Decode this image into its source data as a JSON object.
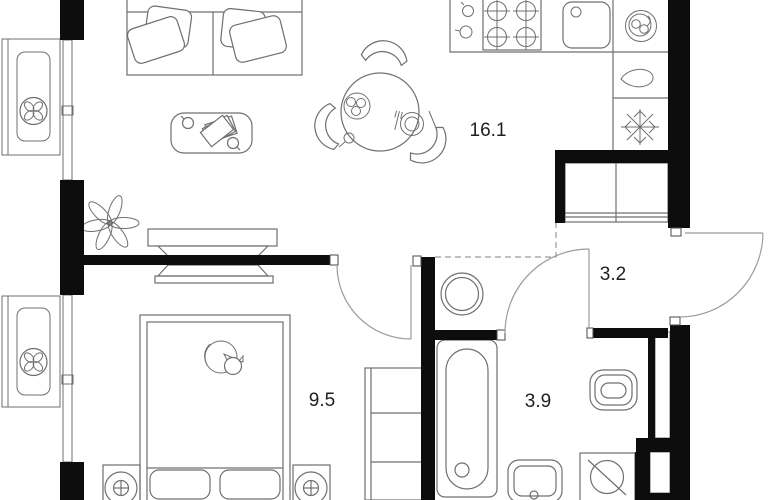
{
  "floor_plan": {
    "rooms": [
      {
        "id": "kitchen-living",
        "area_label": "16.1"
      },
      {
        "id": "hallway",
        "area_label": "3.2"
      },
      {
        "id": "bedroom",
        "area_label": "9.5"
      },
      {
        "id": "bathroom",
        "area_label": "3.9"
      }
    ],
    "colors": {
      "wall": "#0d0d0d",
      "furniture_line": "#6f6f6f",
      "door_line": "#9b9b9b",
      "background": "#ffffff",
      "label_text": "#1f1f1f"
    },
    "fixtures": {
      "living": [
        "sofa",
        "coffee-table",
        "plant",
        "tv-unit",
        "dining-table",
        "dining-chairs"
      ],
      "kitchen": [
        "stove-4-burners",
        "kitchen-sink",
        "dishes-icon",
        "drop-icon",
        "snowflake-freezer-icon"
      ],
      "hallway": [
        "wardrobe",
        "water-heater",
        "entrance-door"
      ],
      "bedroom": [
        "double-bed",
        "cat",
        "nightstand-left",
        "nightstand-right",
        "shelving-unit"
      ],
      "bathroom": [
        "bathtub",
        "wash-basin",
        "toilet",
        "washing-machine"
      ],
      "balcony": [
        "ac-unit-top",
        "ac-unit-bottom"
      ]
    }
  }
}
